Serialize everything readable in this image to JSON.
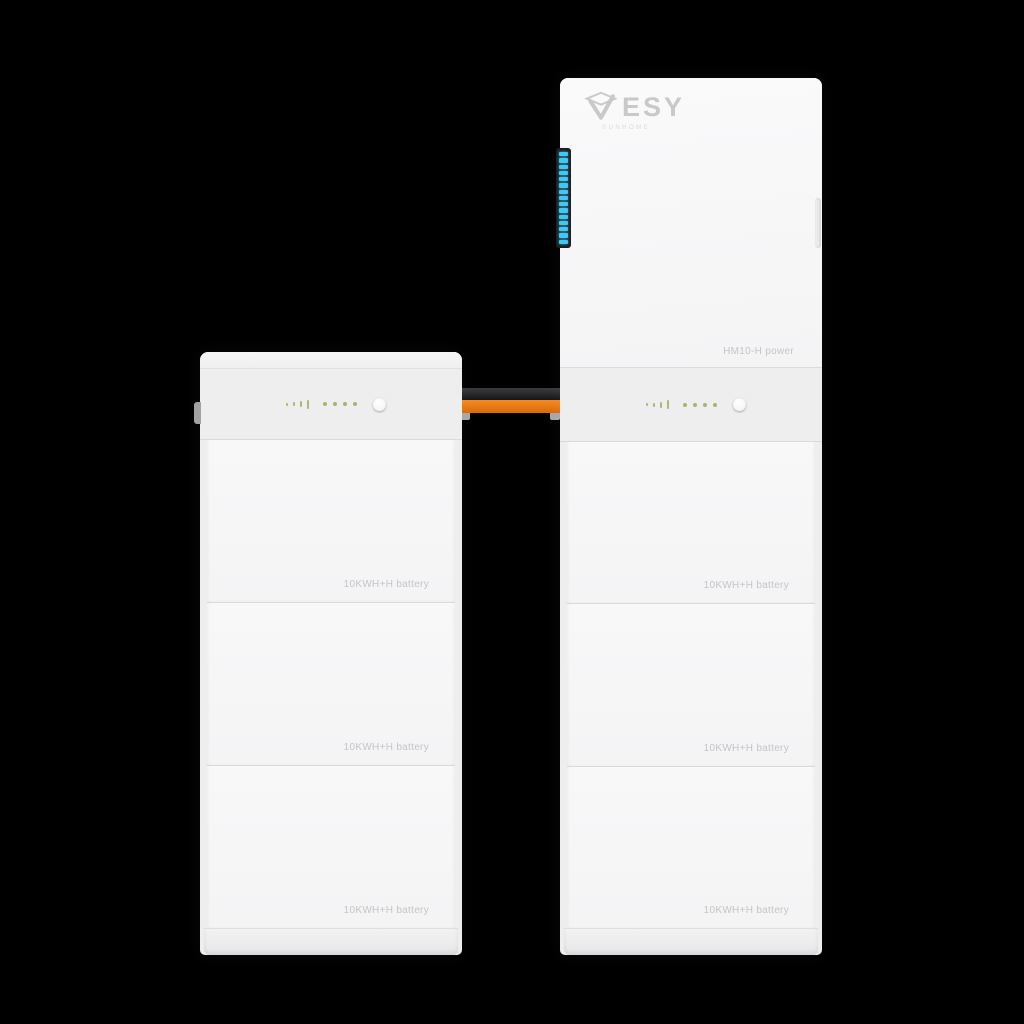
{
  "scene": {
    "background_color": "#000000",
    "product": "ESY Sunhome modular home energy storage system",
    "tower_count": 2
  },
  "brand": {
    "logo_text": "ESY",
    "logo_tagline": "SUNHOME",
    "logo_icon": "esy-check-mark-icon",
    "logo_color": "#c9c9cb"
  },
  "left_tower": {
    "type": "battery stack",
    "modules": [
      {
        "label": "10KWH+H battery"
      },
      {
        "label": "10KWH+H battery"
      },
      {
        "label": "10KWH+H battery"
      }
    ]
  },
  "right_tower": {
    "type": "power module with battery stack",
    "power_module": {
      "label": "HM10-H power",
      "led_strip": {
        "segment_count": 15,
        "segment_color": "#41c8f2",
        "housing_color": "#1c1c1e"
      }
    },
    "modules": [
      {
        "label": "10KWH+H battery"
      },
      {
        "label": "10KWH+H battery"
      },
      {
        "label": "10KWH+H battery"
      }
    ]
  },
  "indicator_panel": {
    "level_bar_count": 4,
    "status_led_count": 4,
    "led_color": "#9fae62"
  },
  "cables": {
    "top_cable_color": "#1f1f21",
    "bottom_cable_color": "#ec7912"
  }
}
